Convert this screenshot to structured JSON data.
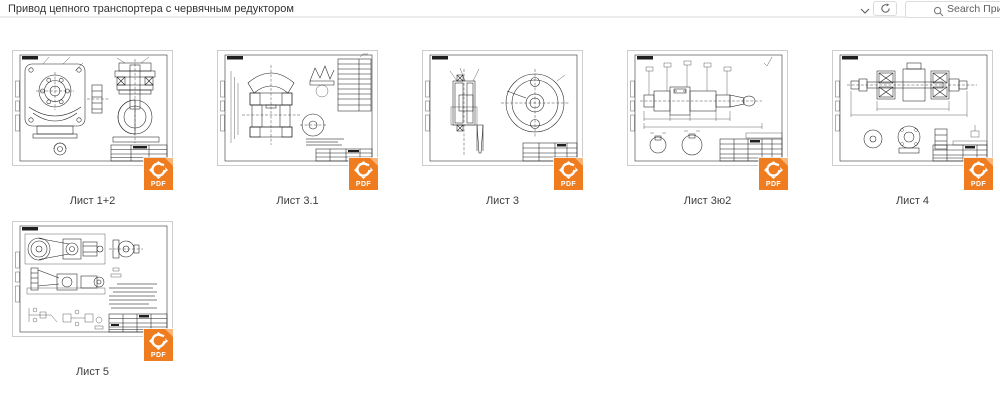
{
  "header": {
    "title": "Привод цепного транспортера с червячным редуктором",
    "search_placeholder": "Search Привод цепног",
    "icons": {
      "chevron": "chevron-down",
      "refresh": "refresh-circular-arrow",
      "search": "magnifier"
    }
  },
  "files": [
    {
      "label": "Лист 1+2",
      "type": "PDF"
    },
    {
      "label": "Лист 3.1",
      "type": "PDF"
    },
    {
      "label": "Лист 3",
      "type": "PDF"
    },
    {
      "label": "Лист 3ю2",
      "type": "PDF"
    },
    {
      "label": "Лист 4",
      "type": "PDF"
    },
    {
      "label": "Лист 5",
      "type": "PDF"
    }
  ],
  "colors": {
    "badge_orange": "#ef7d20",
    "sheet_border": "#cdcdcd"
  }
}
